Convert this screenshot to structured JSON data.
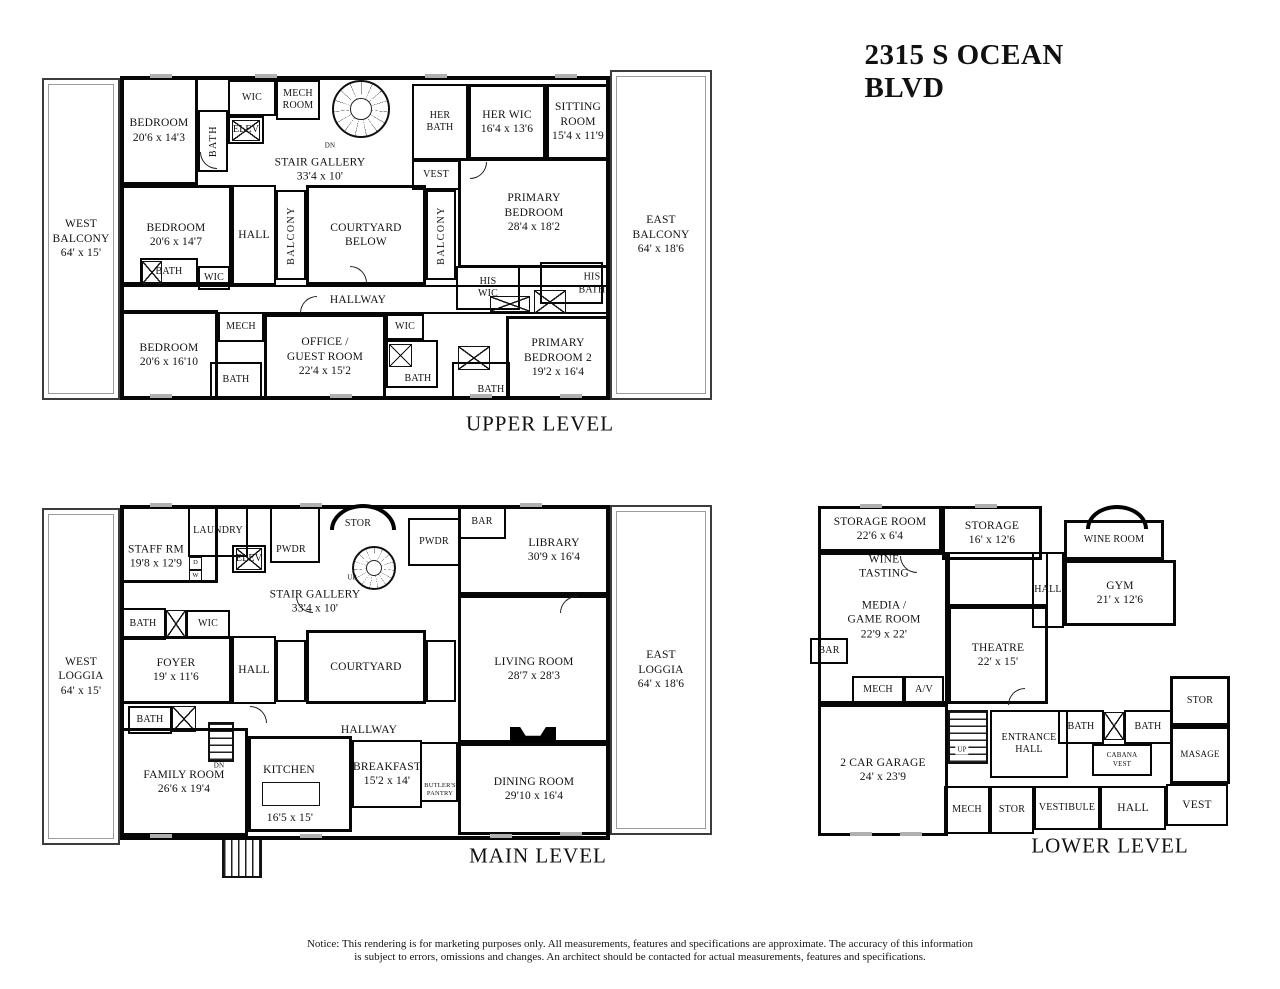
{
  "title": "2315 S OCEAN BLVD",
  "notice": {
    "line1": "Notice: This rendering is for marketing purposes only. All measurements, features and specifications are approximate. The accuracy of this information",
    "line2": "is subject to errors, omissions and changes. An architect should be contacted for actual measurements, features and specifications."
  },
  "upper": {
    "label": "UPPER LEVEL",
    "rooms": {
      "west_balcony": {
        "name": "WEST BALCONY",
        "dims": "64' x 15'"
      },
      "east_balcony": {
        "name": "EAST BALCONY",
        "dims": "64' x 18'6"
      },
      "bedroom1": {
        "name": "BEDROOM",
        "dims": "20'6 x 14'3"
      },
      "wic_top": {
        "name": "WIC"
      },
      "mech_room": {
        "name": "MECH ROOM"
      },
      "bath_v": {
        "name": "BATH"
      },
      "elev": {
        "name": "ELEV"
      },
      "stair_dn": {
        "name": "DN"
      },
      "stair_gallery": {
        "name": "STAIR GALLERY",
        "dims": "33'4 x 10'"
      },
      "her_bath": {
        "name": "HER BATH"
      },
      "her_wic": {
        "name": "HER WIC",
        "dims": "16'4 x 13'6"
      },
      "sitting_room": {
        "name": "SITTING ROOM",
        "dims": "15'4 x 11'9"
      },
      "vest": {
        "name": "VEST"
      },
      "bedroom2": {
        "name": "BEDROOM",
        "dims": "20'6 x 14'7"
      },
      "hall": {
        "name": "HALL"
      },
      "balcony_left": {
        "name": "BALCONY"
      },
      "courtyard_below": {
        "name": "COURTYARD BELOW"
      },
      "balcony_right": {
        "name": "BALCONY"
      },
      "primary_bedroom": {
        "name": "PRIMARY BEDROOM",
        "dims": "28'4 x 18'2"
      },
      "bath2": {
        "name": "BATH"
      },
      "wic2": {
        "name": "WIC"
      },
      "his_wic": {
        "name": "HIS WIC"
      },
      "his_bath": {
        "name": "HIS BATH"
      },
      "hallway": {
        "name": "HALLWAY"
      },
      "bedroom3": {
        "name": "BEDROOM",
        "dims": "20'6 x 16'10"
      },
      "mech": {
        "name": "MECH"
      },
      "office_guest": {
        "name": "OFFICE / GUEST ROOM",
        "dims": "22'4 x 15'2"
      },
      "wic3": {
        "name": "WIC"
      },
      "bath3": {
        "name": "BATH"
      },
      "bath4": {
        "name": "BATH"
      },
      "bath5": {
        "name": "BATH"
      },
      "primary_bedroom2": {
        "name": "PRIMARY BEDROOM 2",
        "dims": "19'2 x 16'4"
      }
    }
  },
  "main": {
    "label": "MAIN LEVEL",
    "rooms": {
      "west_loggia": {
        "name": "WEST LOGGIA",
        "dims": "64' x 15'"
      },
      "east_loggia": {
        "name": "EAST LOGGIA",
        "dims": "64' x 18'6"
      },
      "staff_rm": {
        "name": "STAFF RM",
        "dims": "19'8 x 12'9"
      },
      "laundry": {
        "name": "LAUNDRY"
      },
      "laundry_d": {
        "name": "D"
      },
      "laundry_w": {
        "name": "W"
      },
      "elev": {
        "name": "ELEV"
      },
      "pwdr_left": {
        "name": "PWDR"
      },
      "stor": {
        "name": "STOR"
      },
      "stair_up": {
        "name": "UP"
      },
      "pwdr_right": {
        "name": "PWDR"
      },
      "bar": {
        "name": "BAR"
      },
      "library": {
        "name": "LIBRARY",
        "dims": "30'9 x 16'4"
      },
      "stair_gallery": {
        "name": "STAIR GALLERY",
        "dims": "33'4 x 10'"
      },
      "bath1": {
        "name": "BATH"
      },
      "wic": {
        "name": "WIC"
      },
      "foyer": {
        "name": "FOYER",
        "dims": "19' x 11'6"
      },
      "hall": {
        "name": "HALL"
      },
      "courtyard": {
        "name": "COURTYARD"
      },
      "living_room": {
        "name": "LIVING ROOM",
        "dims": "28'7 x 28'3"
      },
      "bath2": {
        "name": "BATH"
      },
      "family_room": {
        "name": "FAMILY ROOM",
        "dims": "26'6  x 19'4"
      },
      "kitchen": {
        "name": "KITCHEN",
        "dims": "16'5 x 15'"
      },
      "stair_dn": {
        "name": "DN"
      },
      "hallway": {
        "name": "HALLWAY"
      },
      "breakfast": {
        "name": "BREAKFAST",
        "dims": "15'2  x 14'"
      },
      "butlers_pantry": {
        "name": "BUTLER'S PANTRY"
      },
      "dining_room": {
        "name": "DINING ROOM",
        "dims": "29'10  x 16'4"
      }
    }
  },
  "lower": {
    "label": "LOWER LEVEL",
    "rooms": {
      "storage_room": {
        "name": "STORAGE ROOM",
        "dims": "22'6 x 6'4"
      },
      "storage": {
        "name": "STORAGE",
        "dims": "16' x 12'6"
      },
      "wine_room": {
        "name": "WINE ROOM"
      },
      "wine_tasting": {
        "name": "WINE TASTING"
      },
      "hall_upper": {
        "name": "HALL"
      },
      "gym": {
        "name": "GYM",
        "dims": "21' x 12'6"
      },
      "media_game": {
        "name": "MEDIA / GAME ROOM",
        "dims": "22'9 x 22'"
      },
      "theatre": {
        "name": "THEATRE",
        "dims": "22' x 15'"
      },
      "bar": {
        "name": "BAR"
      },
      "mech": {
        "name": "MECH"
      },
      "av": {
        "name": "A/V"
      },
      "stor_right": {
        "name": "STOR"
      },
      "garage": {
        "name": "2 CAR GARAGE",
        "dims": "24' x 23'9"
      },
      "stair_up": {
        "name": "UP"
      },
      "entrance_hall": {
        "name": "ENTRANCE HALL"
      },
      "mech2": {
        "name": "MECH"
      },
      "stor2": {
        "name": "STOR"
      },
      "vestibule": {
        "name": "VESTIBULE"
      },
      "bath_left": {
        "name": "BATH"
      },
      "bath_right": {
        "name": "BATH"
      },
      "cabana_vest": {
        "name": "CABANA VEST"
      },
      "masage": {
        "name": "MASAGE"
      },
      "hall_lower": {
        "name": "HALL"
      },
      "vest": {
        "name": "VEST"
      }
    }
  }
}
